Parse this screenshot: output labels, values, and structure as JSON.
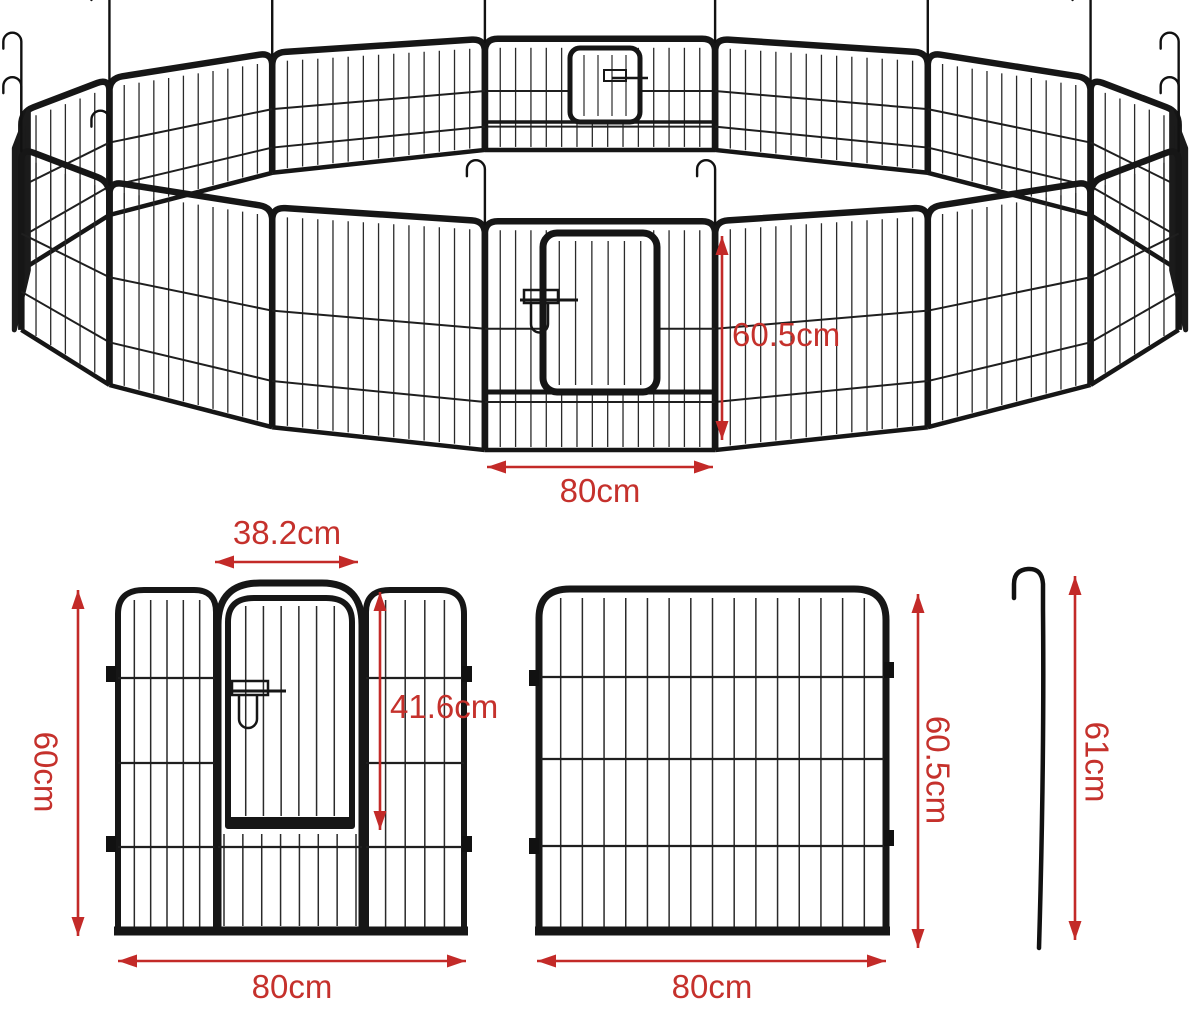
{
  "figure": {
    "type": "product-dimension-diagram",
    "subject": "metal pet playpen fence ring with door panels and ground stake",
    "ring_panel_count": 16
  },
  "colors": {
    "dimension_red": "#c32a28",
    "label_red": "#c5312c",
    "fence_black": "#161616",
    "background": "#ffffff"
  },
  "annotations": {
    "ring_panel_height": "60.5cm",
    "ring_front_panel_width": "80cm",
    "door_width": "38.2cm",
    "door_height": "41.6cm",
    "door_panel_height": "60cm",
    "door_panel_width": "80cm",
    "plain_panel_height": "60.5cm",
    "plain_panel_width": "80cm",
    "stake_length": "61cm"
  }
}
